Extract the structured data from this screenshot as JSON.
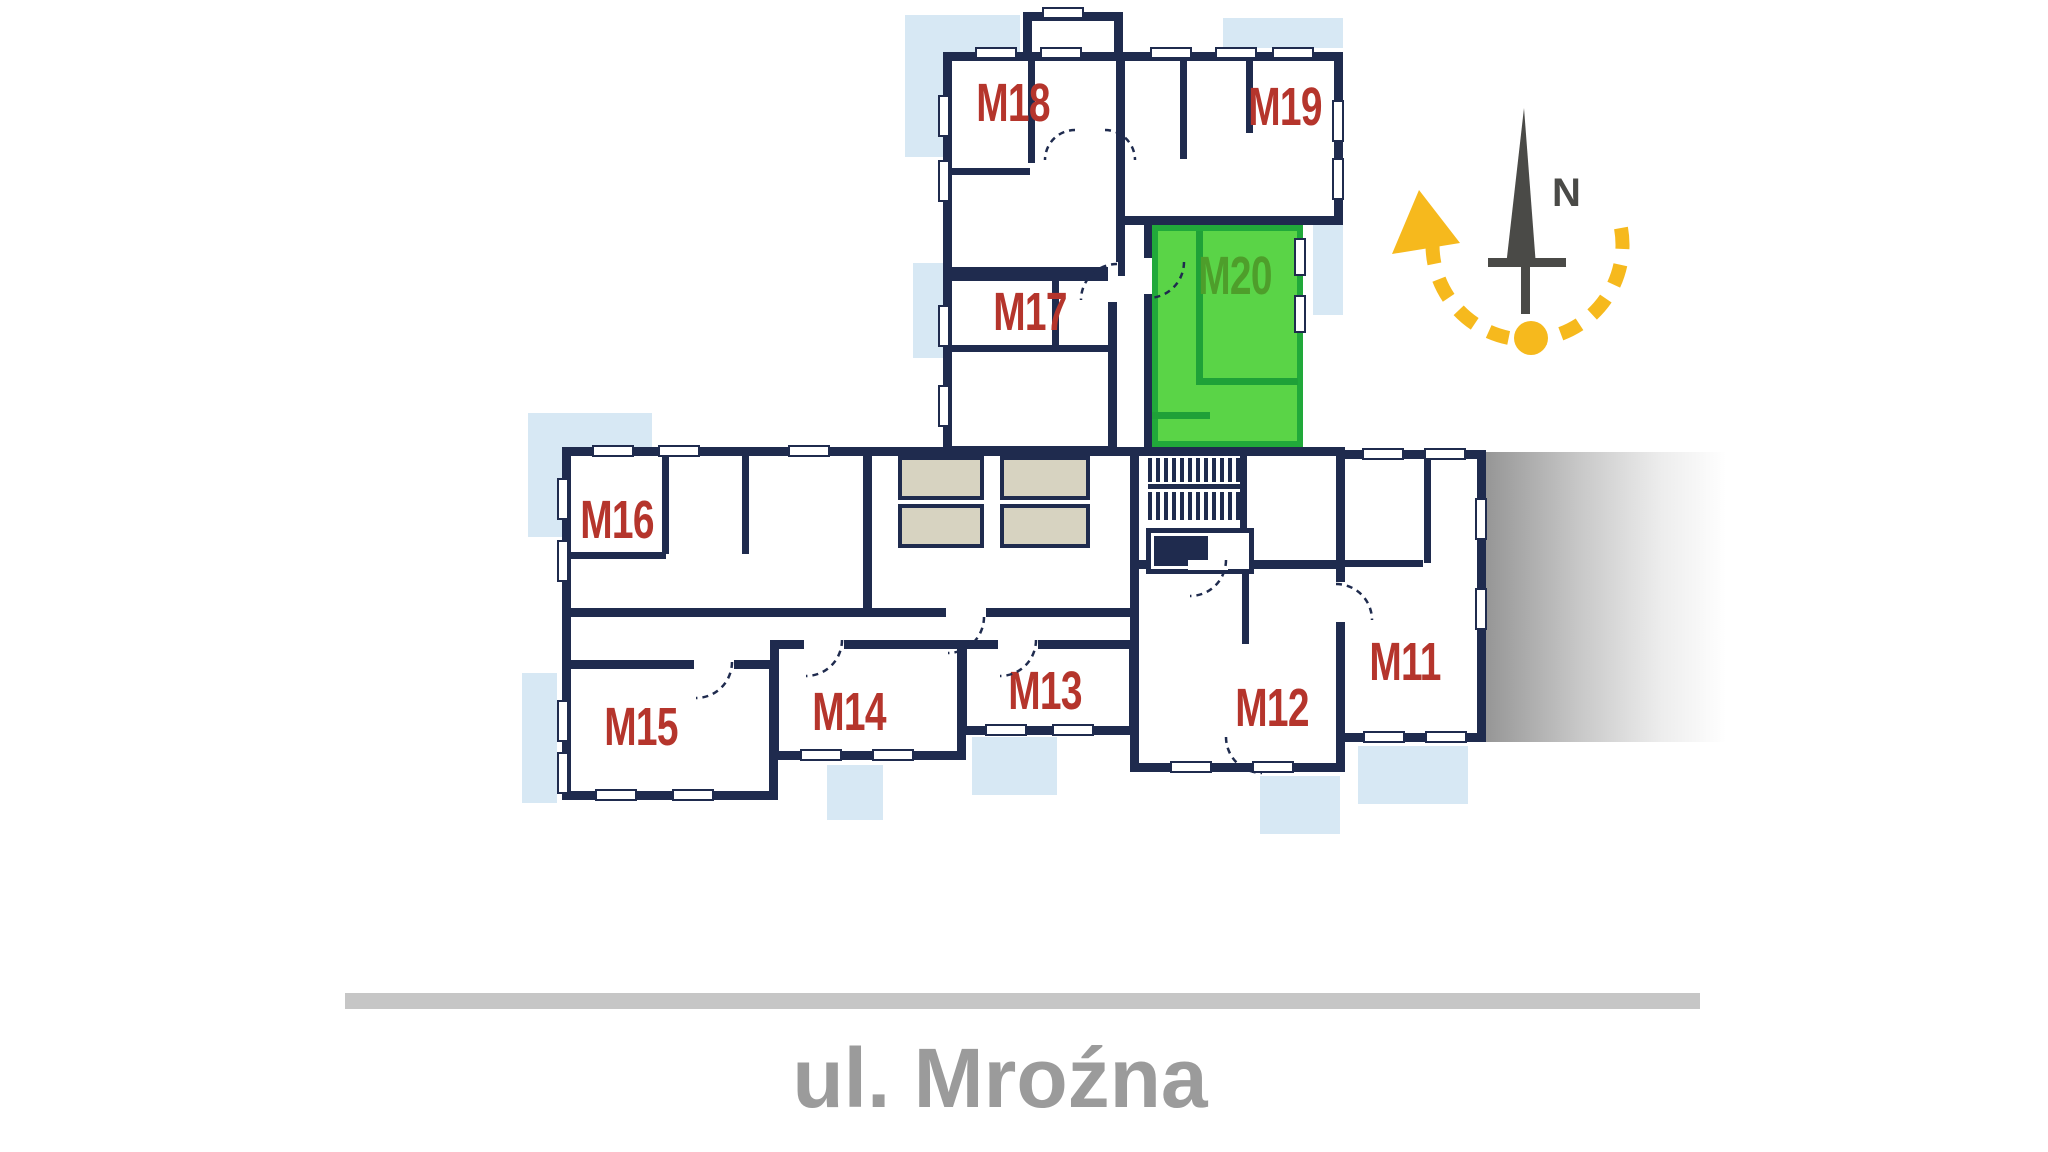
{
  "apartments": [
    {
      "id": "m18",
      "label": "M18",
      "highlighted": false
    },
    {
      "id": "m19",
      "label": "M19",
      "highlighted": false
    },
    {
      "id": "m17",
      "label": "M17",
      "highlighted": false
    },
    {
      "id": "m20",
      "label": "M20",
      "highlighted": true
    },
    {
      "id": "m16",
      "label": "M16",
      "highlighted": false
    },
    {
      "id": "m15",
      "label": "M15",
      "highlighted": false
    },
    {
      "id": "m14",
      "label": "M14",
      "highlighted": false
    },
    {
      "id": "m13",
      "label": "M13",
      "highlighted": false
    },
    {
      "id": "m12",
      "label": "M12",
      "highlighted": false
    },
    {
      "id": "m11",
      "label": "M11",
      "highlighted": false
    }
  ],
  "street": {
    "name": "ul. Mroźna"
  },
  "compass": {
    "north_label": "N"
  },
  "colors": {
    "wall": "#1f2b4e",
    "apartment_label": "#b5352c",
    "highlight_fill": "#5ad447",
    "highlight_border": "#21a93a",
    "highlight_label": "#4e9e2b",
    "balcony": "#d7e8f4",
    "service_room": "#d7d3c1",
    "compass_accent": "#f6b91d",
    "compass_needle": "#4a4a47",
    "street_text": "#9b9b9b"
  }
}
